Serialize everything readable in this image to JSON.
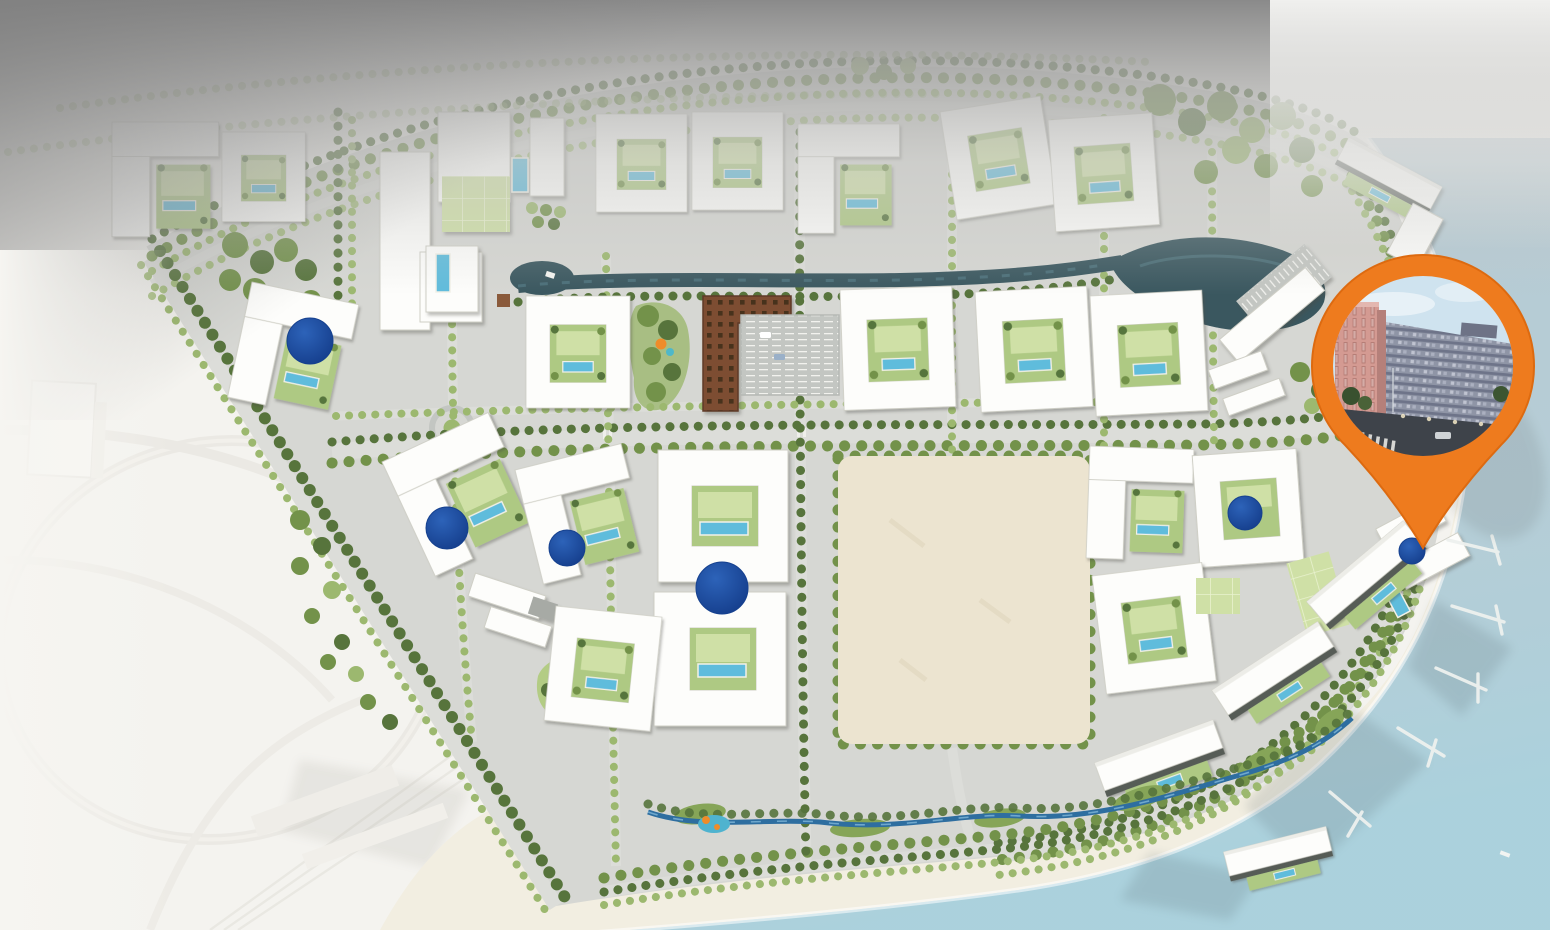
{
  "map": {
    "kind": "residential-masterplan-aerial-site-map",
    "regions": [
      "sea",
      "beach",
      "marina-piers",
      "canal",
      "lagoon",
      "central-vacant-plot",
      "highway-interchange",
      "tree-lined-boulevard",
      "residential-court-buildings",
      "pool-courtyards",
      "dome-roof-buildings",
      "retail-block",
      "parking-lot",
      "playground",
      "pocket-park",
      "roundabout",
      "beach-stream",
      "coastal-buildings"
    ],
    "marker": {
      "icon": "map-pin-icon",
      "style": "teardrop-pin-with-circular-photo",
      "photo": "street-photo-apartment-buildings-icon",
      "dome_count": 6
    }
  },
  "colors": {
    "pin": "#ee7b1e",
    "pin_edge": "#dd6a10",
    "dome": "#1d4da1",
    "sea": "#b6ccd5",
    "sea_teal": "#aed4de",
    "sand": "#f2eee1",
    "plot": "#ece4d0",
    "site": "#d6d7d3",
    "road": "#c9ccc8",
    "road_light": "#dcddd9",
    "building": "#fdfdfb",
    "building_stroke": "#cfcfc6",
    "roof_dark": "#565b57",
    "tree": "#73924a",
    "tree_dark": "#57743c",
    "tree_light": "#9cb86f",
    "lawn": "#cfe0a6",
    "court": "#aec983",
    "pool": "#5fbcdc",
    "canal": "#3a575f",
    "brown": "#7d4d33",
    "grey_top": "#8a8a8a",
    "outside": "#f4f3ef",
    "photo_sky": "#cfe3ef",
    "photo_pink": "#d49a92",
    "photo_grey": "#8f95a6",
    "photo_road": "#3e434a"
  }
}
